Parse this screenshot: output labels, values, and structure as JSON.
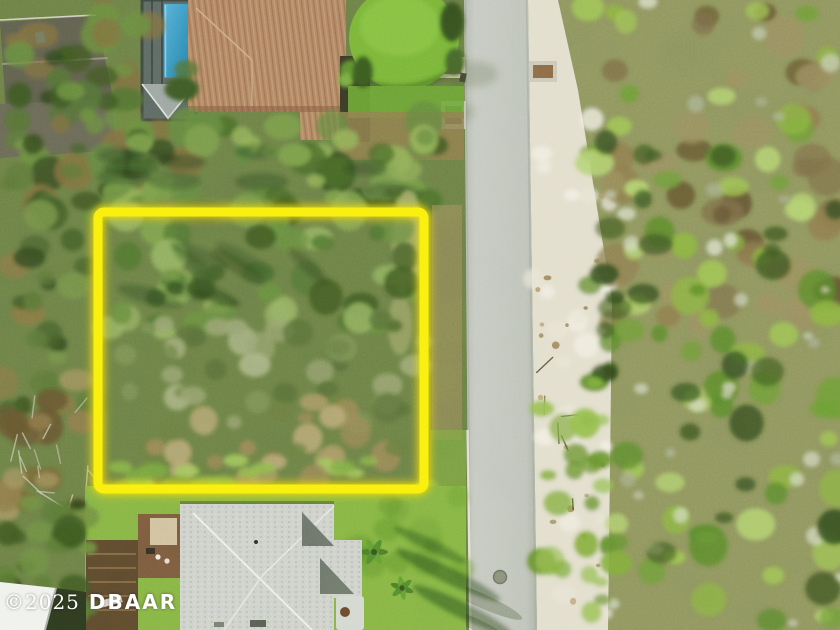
{
  "scene": {
    "description": "Aerial drone photo of a vacant wooded residential lot outlined with a yellow highlight box, beside a light gray street with sandy shoulder and coastal scrub on the right, houses at top and bottom",
    "palette": {
      "highlight": "#f9ec0a",
      "highlight_glow": "#e8d400",
      "road": "#b7bab6",
      "sand": "#ded8c8",
      "canopy_base": "#5c6c40",
      "scrub_base": "#7c8156",
      "lawn": "#74a63e",
      "lawn_mound": "#69a733",
      "pool_water": "#2e82b8",
      "tile_roof": "#a5735c",
      "shingle_roof": "#c6c8c5",
      "gray_roof": "#514e48",
      "deck": "#4f3a29",
      "white_roof": "#edefeb"
    }
  },
  "watermark": {
    "year": "©2025",
    "name": "DBAAR",
    "color": "#ffffff"
  }
}
